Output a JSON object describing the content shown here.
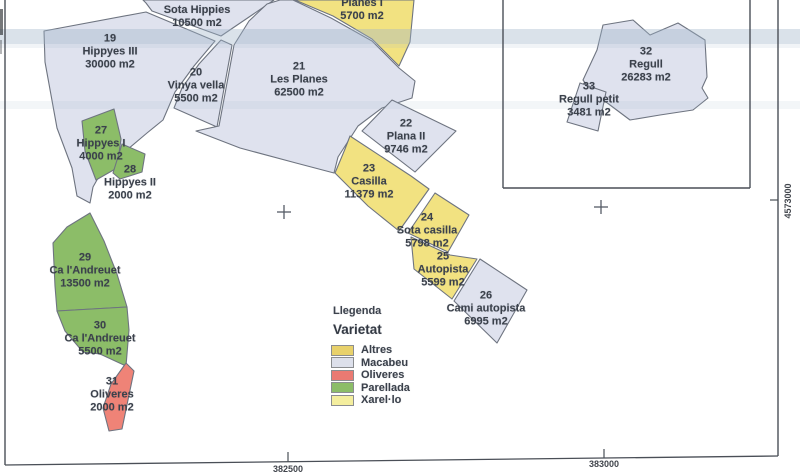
{
  "colors": {
    "macabeu": "#dfe2ee",
    "yellow": "#f2e281",
    "green": "#8cbd68",
    "red": "#ef8377",
    "stroke": "#6e7480",
    "frame": "#4a4f57",
    "band": "#9fb2c9",
    "text": "#3b414b"
  },
  "map": {
    "parcels": [
      {
        "number": "",
        "name": "Sota Hippies",
        "area": "10500 m2",
        "variety": "Macabeu",
        "color": "macabeu",
        "label": {
          "x": 197,
          "y": 17
        },
        "polygon": [
          [
            143,
            0
          ],
          [
            274,
            0
          ],
          [
            252,
            15
          ],
          [
            221,
            36
          ],
          [
            152,
            11
          ],
          [
            146,
            3
          ]
        ]
      },
      {
        "number": "19",
        "name": "Hippyes III",
        "area": "30000 m2",
        "variety": "Macabeu",
        "color": "macabeu",
        "label": {
          "x": 110,
          "y": 52
        },
        "polygon": [
          [
            44,
            31
          ],
          [
            146,
            12
          ],
          [
            215,
            41
          ],
          [
            194,
            66
          ],
          [
            175,
            92
          ],
          [
            163,
            120
          ],
          [
            147,
            133
          ],
          [
            102,
            171
          ],
          [
            93,
            187
          ],
          [
            90,
            203
          ],
          [
            77,
            196
          ],
          [
            72,
            168
          ],
          [
            57,
            128
          ],
          [
            45,
            62
          ]
        ]
      },
      {
        "number": "",
        "name": "Planes I",
        "area": "5700 m2",
        "variety": "Xarel·lo",
        "color": "yellow",
        "label": {
          "x": 362,
          "y": 10
        },
        "polygon": [
          [
            295,
            0
          ],
          [
            414,
            0
          ],
          [
            410,
            42
          ],
          [
            399,
            66
          ],
          [
            372,
            39
          ],
          [
            333,
            16
          ]
        ]
      },
      {
        "number": "20",
        "name": "Vinya vella",
        "area": "5500 m2",
        "variety": "Macabeu",
        "color": "macabeu",
        "label": {
          "x": 196,
          "y": 86
        },
        "polygon": [
          [
            221,
            40
          ],
          [
            232,
            45
          ],
          [
            225,
            83
          ],
          [
            217,
            127
          ],
          [
            174,
            108
          ],
          [
            182,
            88
          ],
          [
            199,
            64
          ]
        ]
      },
      {
        "number": "21",
        "name": "Les Planes",
        "area": "62500 m2",
        "variety": "Macabeu",
        "color": "macabeu",
        "label": {
          "x": 299,
          "y": 80
        },
        "polygon": [
          [
            280,
            0
          ],
          [
            293,
            0
          ],
          [
            331,
            18
          ],
          [
            372,
            41
          ],
          [
            399,
            68
          ],
          [
            415,
            81
          ],
          [
            412,
            98
          ],
          [
            382,
            108
          ],
          [
            358,
            126
          ],
          [
            338,
            157
          ],
          [
            334,
            173
          ],
          [
            296,
            163
          ],
          [
            240,
            148
          ],
          [
            196,
            131
          ],
          [
            219,
            126
          ],
          [
            227,
            83
          ],
          [
            234,
            45
          ],
          [
            249,
            21
          ],
          [
            267,
            4
          ]
        ]
      },
      {
        "number": "22",
        "name": "Plana II",
        "area": "9746 m2",
        "variety": "Macabeu",
        "color": "macabeu",
        "label": {
          "x": 406,
          "y": 137
        },
        "polygon": [
          [
            362,
            131
          ],
          [
            392,
            100
          ],
          [
            456,
            131
          ],
          [
            415,
            172
          ]
        ]
      },
      {
        "number": "23",
        "name": "Casilla",
        "area": "11379 m2",
        "variety": "Xarel·lo",
        "color": "yellow",
        "label": {
          "x": 369,
          "y": 182
        },
        "polygon": [
          [
            350,
            136
          ],
          [
            411,
            176
          ],
          [
            429,
            189
          ],
          [
            399,
            231
          ],
          [
            368,
            206
          ],
          [
            335,
            173
          ],
          [
            345,
            149
          ]
        ]
      },
      {
        "number": "24",
        "name": "Sota casilla",
        "area": "5798 m2",
        "variety": "Xarel·lo",
        "color": "yellow",
        "label": {
          "x": 427,
          "y": 231
        },
        "polygon": [
          [
            435,
            193
          ],
          [
            469,
            215
          ],
          [
            448,
            252
          ],
          [
            408,
            233
          ]
        ]
      },
      {
        "number": "25",
        "name": "Autopista",
        "area": "5599 m2",
        "variety": "Xarel·lo",
        "color": "yellow",
        "label": {
          "x": 443,
          "y": 270
        },
        "polygon": [
          [
            411,
            237
          ],
          [
            450,
            255
          ],
          [
            477,
            259
          ],
          [
            452,
            299
          ],
          [
            414,
            269
          ]
        ]
      },
      {
        "number": "26",
        "name": "Cami autopista",
        "area": "6995 m2",
        "variety": "Macabeu",
        "color": "macabeu",
        "label": {
          "x": 486,
          "y": 309
        },
        "polygon": [
          [
            480,
            259
          ],
          [
            527,
            290
          ],
          [
            497,
            343
          ],
          [
            454,
            301
          ]
        ]
      },
      {
        "number": "27",
        "name": "Hippyes I",
        "area": "4000 m2",
        "variety": "Parellada",
        "color": "green",
        "label": {
          "x": 101,
          "y": 144
        },
        "polygon": [
          [
            82,
            121
          ],
          [
            114,
            109
          ],
          [
            121,
            139
          ],
          [
            117,
            168
          ],
          [
            96,
            180
          ],
          [
            85,
            151
          ]
        ]
      },
      {
        "number": "28",
        "name": "Hippyes II",
        "area": "2000 m2",
        "variety": "Parellada",
        "color": "green",
        "label": {
          "x": 130,
          "y": 183
        },
        "polygon": [
          [
            122,
            144
          ],
          [
            145,
            154
          ],
          [
            142,
            172
          ],
          [
            120,
            179
          ],
          [
            113,
            173
          ]
        ]
      },
      {
        "number": "29",
        "name": "Ca l'Andreuet",
        "area": "13500 m2",
        "variety": "Parellada",
        "color": "green",
        "label": {
          "x": 85,
          "y": 271
        },
        "polygon": [
          [
            90,
            213
          ],
          [
            104,
            241
          ],
          [
            117,
            274
          ],
          [
            127,
            307
          ],
          [
            57,
            311
          ],
          [
            55,
            286
          ],
          [
            53,
            243
          ],
          [
            67,
            227
          ]
        ]
      },
      {
        "number": "30",
        "name": "Ca l'Andreuet",
        "area": "5500 m2",
        "variety": "Parellada",
        "color": "green",
        "label": {
          "x": 100,
          "y": 339
        },
        "polygon": [
          [
            57,
            311
          ],
          [
            127,
            307
          ],
          [
            129,
            330
          ],
          [
            126,
            366
          ],
          [
            100,
            354
          ],
          [
            83,
            352
          ],
          [
            65,
            331
          ]
        ]
      },
      {
        "number": "31",
        "name": "Oliveres",
        "area": "2000 m2",
        "variety": "Oliveres",
        "color": "red",
        "label": {
          "x": 112,
          "y": 395
        },
        "polygon": [
          [
            126,
            363
          ],
          [
            134,
            371
          ],
          [
            122,
            429
          ],
          [
            109,
            431
          ],
          [
            103,
            408
          ],
          [
            111,
            384
          ]
        ]
      },
      {
        "number": "32",
        "name": "Regull",
        "area": "26283 m2",
        "variety": "Macabeu",
        "color": "macabeu",
        "label": {
          "x": 646,
          "y": 65
        },
        "polygon": [
          [
            603,
            25
          ],
          [
            633,
            20
          ],
          [
            650,
            35
          ],
          [
            678,
            23
          ],
          [
            705,
            40
          ],
          [
            707,
            77
          ],
          [
            702,
            88
          ],
          [
            708,
            98
          ],
          [
            693,
            110
          ],
          [
            660,
            115
          ],
          [
            630,
            120
          ],
          [
            590,
            90
          ],
          [
            583,
            80
          ],
          [
            597,
            50
          ]
        ]
      },
      {
        "number": "33",
        "name": "Regull petit",
        "area": "3481 m2",
        "variety": "Macabeu",
        "color": "macabeu",
        "label": {
          "x": 589,
          "y": 100
        },
        "polygon": [
          [
            580,
            83
          ],
          [
            606,
            92
          ],
          [
            598,
            131
          ],
          [
            567,
            122
          ]
        ]
      }
    ],
    "crosses": [
      {
        "x": 284,
        "y": 212
      },
      {
        "x": 601,
        "y": 207
      }
    ],
    "frame": {
      "left": {
        "x": 5,
        "y1": 0,
        "y2": 465
      },
      "right": {
        "x": 778,
        "y1": 0,
        "y2": 456
      },
      "bottom": {
        "x1": 5,
        "y1": 465,
        "x2": 778,
        "y2": 456
      },
      "inset": {
        "x1": 503,
        "x2": 750,
        "y_top": 0,
        "y_bottom": 188
      }
    },
    "axis": {
      "x_ticks": [
        {
          "label": "382500",
          "x": 288,
          "tick_y1": 452,
          "tick_y2": 462,
          "label_y": 469
        },
        {
          "label": "383000",
          "x": 604,
          "tick_y1": 449,
          "tick_y2": 458,
          "label_y": 464
        }
      ],
      "y_ticks": [
        {
          "label": "4573000",
          "tick_x1": 770,
          "tick_x2": 778,
          "y": 200,
          "label_x": 788,
          "label_y": 201
        }
      ]
    },
    "scan_bands": [
      {
        "y": 29,
        "h": 15,
        "opacity": 0.38
      },
      {
        "y": 44,
        "h": 4,
        "opacity": 0.15
      },
      {
        "y": 101,
        "h": 8,
        "opacity": 0.12
      }
    ],
    "edge_smudges": [
      {
        "x": 0,
        "y": 9,
        "w": 3,
        "h": 26,
        "opacity": 0.65
      },
      {
        "x": 0,
        "y": 40,
        "w": 2,
        "h": 14,
        "opacity": 0.35
      }
    ]
  },
  "legend": {
    "title": "Llegenda",
    "heading": "Varietat",
    "items": [
      {
        "label": "Altres",
        "color": "#e8d16b"
      },
      {
        "label": "Macabeu",
        "color": "#dde0eb"
      },
      {
        "label": "Oliveres",
        "color": "#ea7a72"
      },
      {
        "label": "Parellada",
        "color": "#8cbd68"
      },
      {
        "label": "Xarel·lo",
        "color": "#f4ee9e"
      }
    ]
  }
}
